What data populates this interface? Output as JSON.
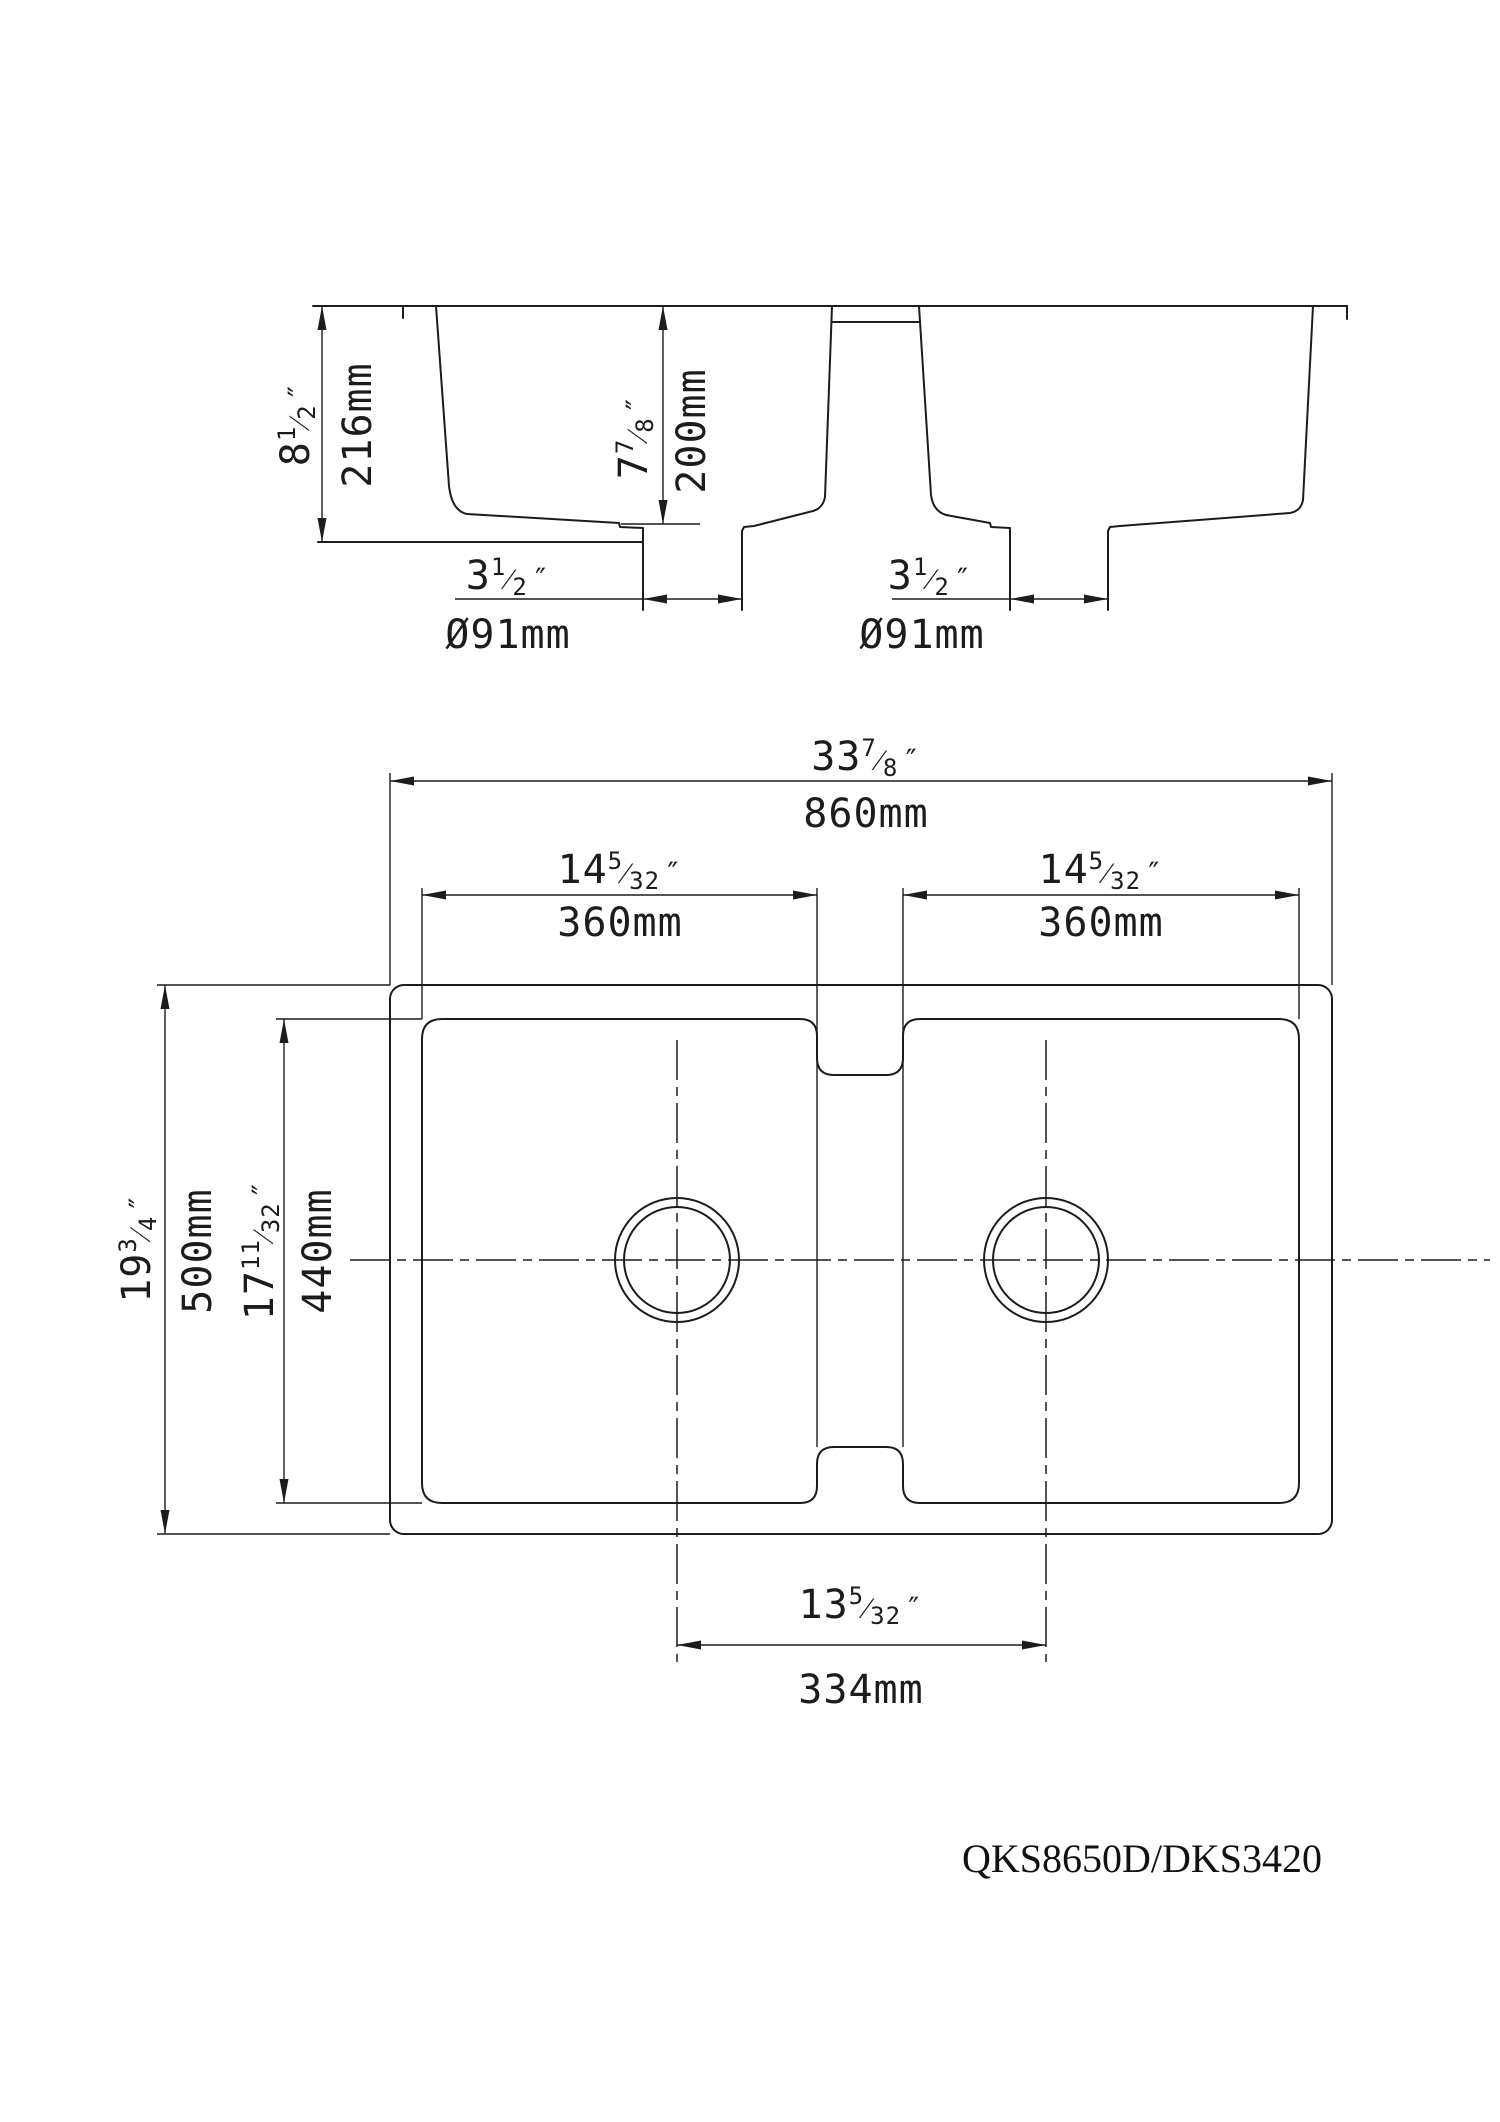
{
  "model": "QKS8650D/DKS3420",
  "symbols": {
    "inch": "″",
    "slash": "⁄"
  },
  "section": {
    "height": {
      "w": "8",
      "n": "1",
      "d": "2"
    },
    "height_mm": "216mm",
    "depth": {
      "w": "7",
      "n": "7",
      "d": "8"
    },
    "depth_mm": "200mm",
    "drain_left": {
      "w": "3",
      "n": "1",
      "d": "2"
    },
    "drain_left_mm": "Ø91mm",
    "drain_right": {
      "w": "3",
      "n": "1",
      "d": "2"
    },
    "drain_right_mm": "Ø91mm"
  },
  "plan": {
    "overall_width": {
      "w": "33",
      "n": "7",
      "d": "8"
    },
    "overall_width_mm": "860mm",
    "bowl_width_left": {
      "w": "14",
      "n": "5",
      "d": "32"
    },
    "bowl_width_left_mm": "360mm",
    "bowl_width_right": {
      "w": "14",
      "n": "5",
      "d": "32"
    },
    "bowl_width_right_mm": "360mm",
    "overall_depth": {
      "w": "19",
      "n": "3",
      "d": "4"
    },
    "overall_depth_mm": "500mm",
    "bowl_length": {
      "w": "17",
      "n": "11",
      "d": "32"
    },
    "bowl_length_mm": "440mm",
    "drain_spacing": {
      "w": "13",
      "n": "5",
      "d": "32"
    },
    "drain_spacing_mm": "334mm"
  }
}
